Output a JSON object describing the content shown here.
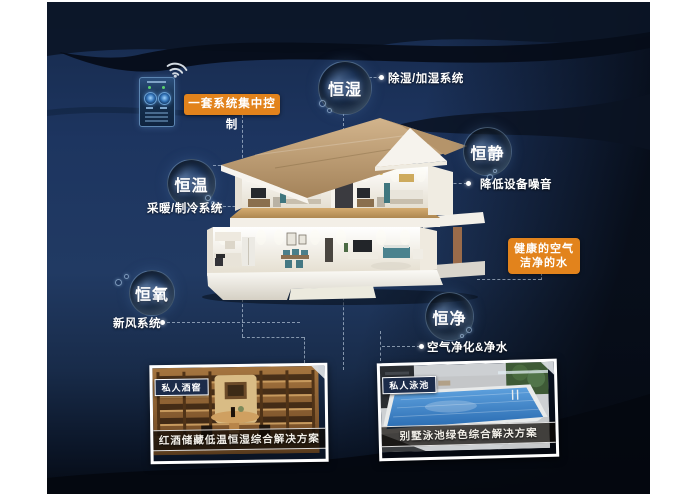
{
  "colors": {
    "accent_orange": "#e2831c",
    "navy_base": "#1d3560",
    "roof_tan": "#c2a076",
    "pool_blue": "#3d85c8"
  },
  "badges": {
    "control_label": "一套系统集中控制",
    "health_line1": "健康的空气",
    "health_line2": "洁净的水"
  },
  "bubbles": [
    {
      "label": "恒湿"
    },
    {
      "label": "恒静"
    },
    {
      "label": "恒温"
    },
    {
      "label": "恒氧"
    },
    {
      "label": "恒净"
    }
  ],
  "labels": {
    "humidity_system": "除湿/加湿系统",
    "noise_reduction": "降低设备噪音",
    "hvac_system": "采暖/制冷系统",
    "fresh_air_system": "新风系统",
    "purification": "空气净化&净水"
  },
  "photos": [
    {
      "tag": "私人酒窖",
      "caption": "红酒储藏低温恒湿综合解决方案"
    },
    {
      "tag": "私人泳池",
      "caption": "别墅泳池绿色综合解决方案"
    }
  ]
}
